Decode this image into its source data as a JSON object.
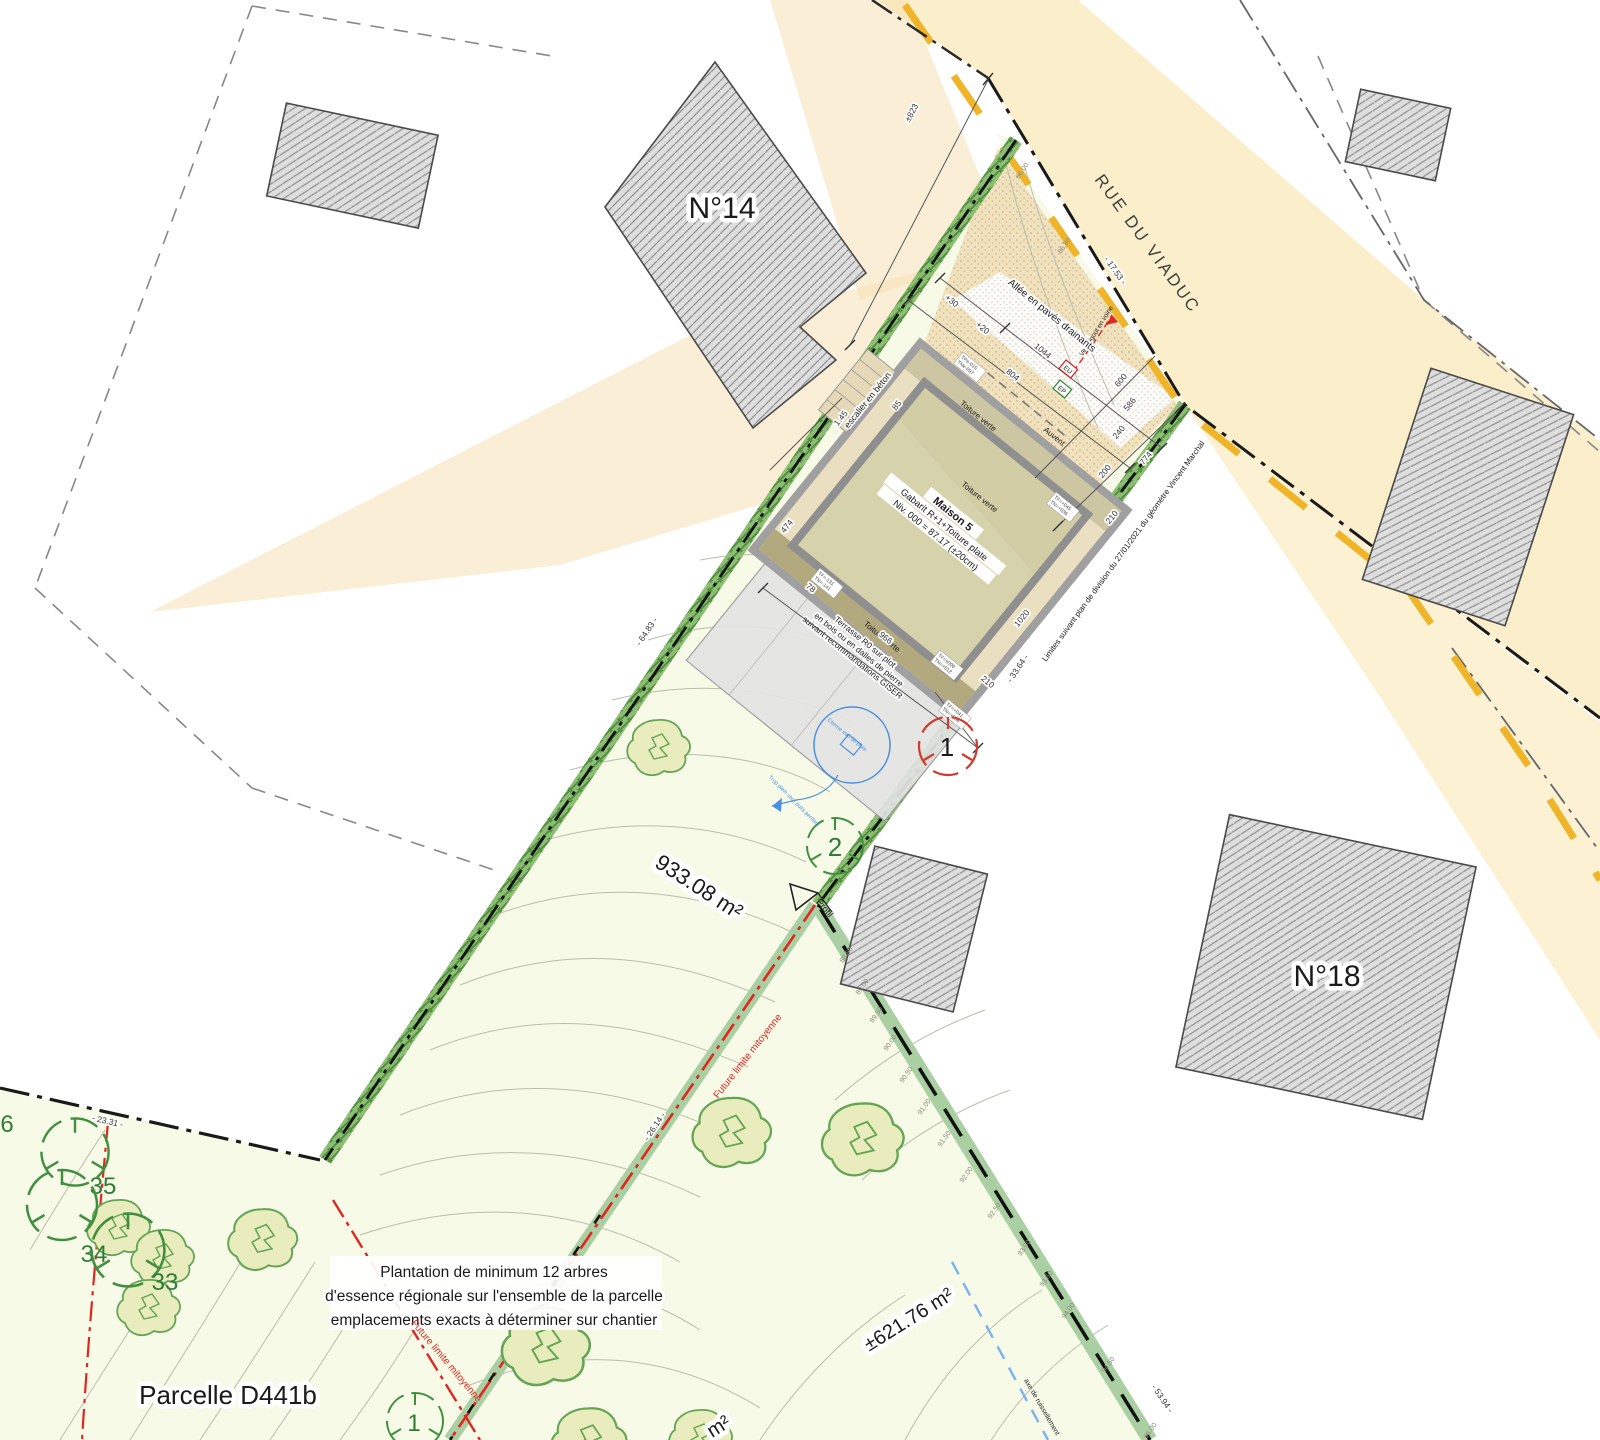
{
  "colors": {
    "road_axis": "#f0b428",
    "road_fill": "#fbeecb",
    "parcel_fill": "#f8fae8",
    "hedge_green": "#6fae58",
    "boundary_red": "#e02620",
    "water_blue": "#6fa8e0",
    "building_gray": "#dedede"
  },
  "labels": {
    "n14": "N°14",
    "n18": "N°18",
    "street": "RUE DU VIADUC",
    "area_main": "933.08 m²",
    "area_lower": "±621.76 m²",
    "area_partial": "m²",
    "parcelle": "Parcelle D441b",
    "plantation_l1": "Plantation de minimum 12 arbres",
    "plantation_l2": "d'essence régionale sur l'ensemble de la parcelle",
    "plantation_l3": "emplacements exacts à déterminer sur chantier",
    "future_limite": "Future limite mitoyenne",
    "limites": "Limites suivant plan de division du 27/01/2021 du géomètre Vincent Marchal",
    "allee": "Allée en pavés drainants",
    "escalier": "escalier en béton",
    "toiture_verte": "Toiture verte",
    "auvent": "Auvent",
    "maison_title": "Maison 5",
    "maison_gabarit": "Gabarit R+1+Toiture plate",
    "maison_niveau": "Niv. 000 = 87.17 (±20cm)",
    "terrasse_l1": "Terrasse R0 sur plot",
    "terrasse_l2": "en bois ou en dalles de pierre",
    "terrasse_l3": "suivant recommandations GISER",
    "vers_egout": "Vers égout en voirie",
    "profil": "Profil",
    "citerne": "Citerne eau de pluie",
    "trop_plein": "Trop plein vers puits perdant",
    "ruissellement": "axe de ruissellement"
  },
  "dimensions": {
    "d823": "±823",
    "d1753": "- 17.53 -",
    "d6483": "- 64.83 -",
    "d3364": "- 33.64 -",
    "d2331": "- 23.31 -",
    "d2614": "- 26.14 -",
    "d5394": "- 53.94 -",
    "d1044": "1044",
    "d804": "804",
    "d600": "600",
    "d586": "586",
    "d240": "240",
    "d774": "774",
    "d200": "200",
    "d210": "210",
    "d966": "966",
    "d78": "78",
    "d474": "474",
    "d145": "1.45",
    "d85": "85",
    "p30": "+30",
    "p20": "+20",
    "d1020": "1020"
  },
  "levels": {
    "tp1": "TPe-015",
    "tn1": "TNe-097",
    "tf2": "TF=+045",
    "tn2": "TN=+036",
    "tf3": "TF=-131",
    "tn3": "TN=-141",
    "tf4": "TF=±000",
    "tn4": "TN=+012",
    "tf5": "TF=+041",
    "tn5": "TN=+036"
  },
  "utilities": {
    "eu": "EU",
    "ep": "EP"
  },
  "trees": {
    "t33": "33",
    "t34": "34",
    "t35": "35",
    "t36": "6",
    "t1": "1",
    "t2": "2",
    "tb1": "1"
  },
  "contours": {
    "c8600": "86.00",
    "c8680": "86.80",
    "c8850": "88.50",
    "c8900": "89.00",
    "c8950": "89.50",
    "c9000": "90.00",
    "c9050": "90.50",
    "c9100": "91.00",
    "c9150": "91.50",
    "c9200": "92.00",
    "c9250": "92.50",
    "c9300": "93.00",
    "c9350": "93.50",
    "c9400": "94.00",
    "c9450": "94.50",
    "c9500": "95.00"
  }
}
